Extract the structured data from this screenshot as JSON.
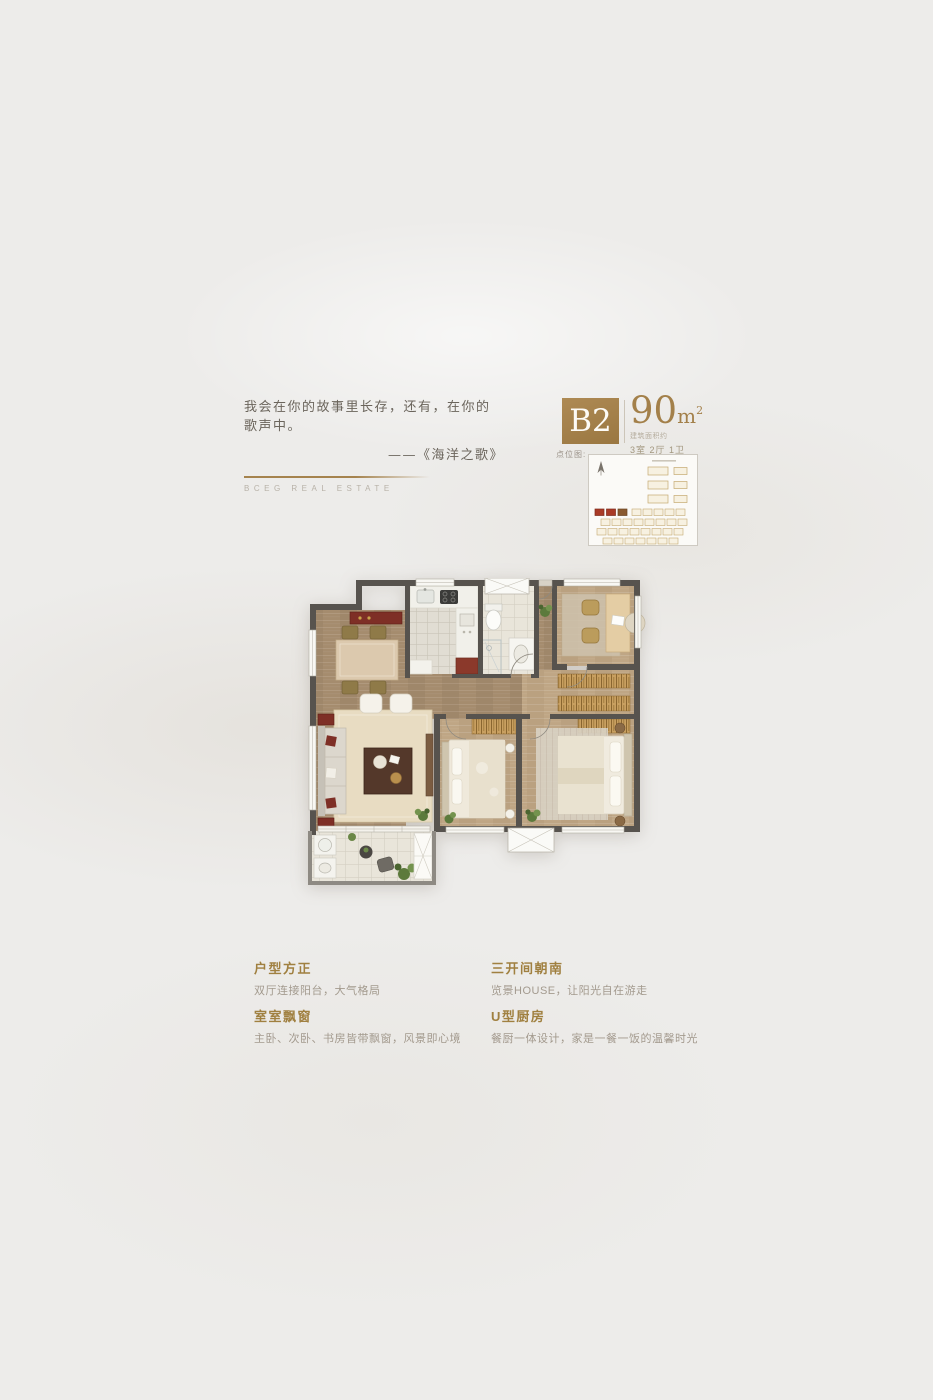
{
  "palette": {
    "accent_gold": "#a3804a",
    "wall_gray": "#57534e",
    "wood_dark": "#a58c6e",
    "wood_light": "#bfa685",
    "red_accent": "#7e2f26",
    "page_bg": "#edecea"
  },
  "header": {
    "quote_line1": "我会在你的故事里长存，还有，在你的歌声中。",
    "quote_line2": "——《海洋之歌》",
    "brand": "BCEG REAL ESTATE"
  },
  "unit": {
    "code": "B2",
    "area_number": "90",
    "area_unit": "m",
    "area_exponent": "2",
    "area_note": "建筑面积约",
    "rooms": "3室 2厅 1卫"
  },
  "siteplan": {
    "label": "点位图:"
  },
  "features": [
    {
      "title": "户型方正",
      "desc": "双厅连接阳台，大气格局"
    },
    {
      "title": "室室飘窗",
      "desc": "主卧、次卧、书房皆带飘窗，风景即心境"
    },
    {
      "title": "三开间朝南",
      "desc": "览景HOUSE，让阳光自在游走"
    },
    {
      "title": "U型厨房",
      "desc": "餐厨一体设计，家是一餐一饭的温馨时光"
    }
  ]
}
